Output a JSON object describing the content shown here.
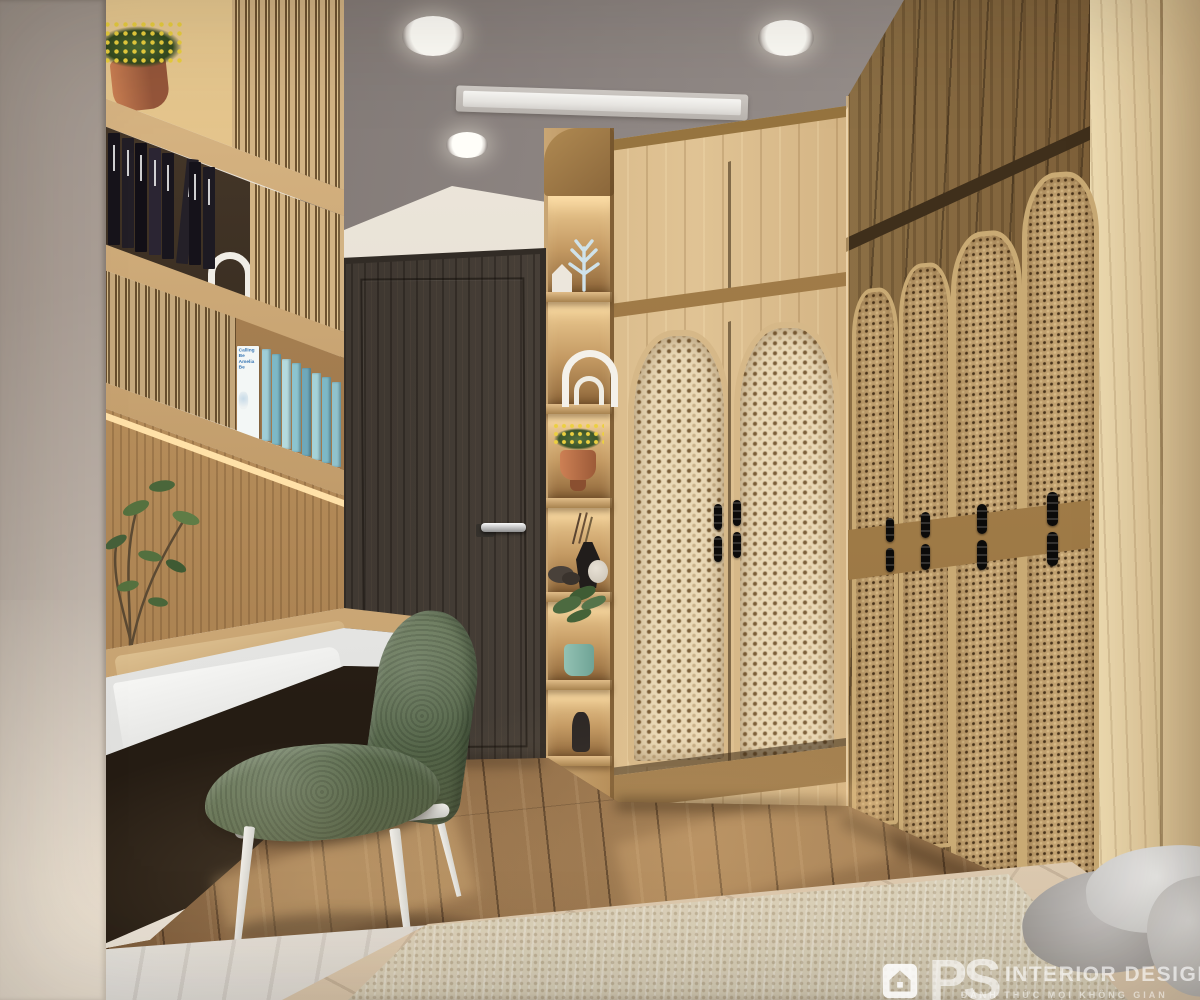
{
  "watermark": {
    "logo_text": "PS",
    "brand_name": "INTERIOR DESIGN",
    "tagline": "ĐÁNH THỨC MỌI KHÔNG GIAN"
  },
  "decor_books": {
    "cover_line1": "Calling Be",
    "cover_line2": "Amelia Be",
    "black_row": [
      "#17141b",
      "#221e26",
      "#120f16",
      "#2b2533",
      "#18151d",
      "#242028",
      "#15121a",
      "#1d1a22"
    ],
    "blue_row": [
      "#9fcdd6",
      "#7db8c6",
      "#b5dade",
      "#8cc4cf",
      "#6fa8ba",
      "#a5d2d8",
      "#7db8c6",
      "#90c2cc"
    ]
  },
  "palette": {
    "ceiling": "#8d8582",
    "wall": "#e9e2d7",
    "wood_light": "#d9ba8a",
    "wood_mid": "#b08a56",
    "door_dark": "#48403a",
    "rattan_light": "#e9d9b8",
    "rattan_dark": "#c0a070",
    "floor_brown": "#7c5c3b",
    "chair_green": "#5d6c50",
    "bed_beige": "#d8c5ac",
    "teal_pot": "#7fb3a5",
    "led_glow": "#ffdfa6"
  }
}
